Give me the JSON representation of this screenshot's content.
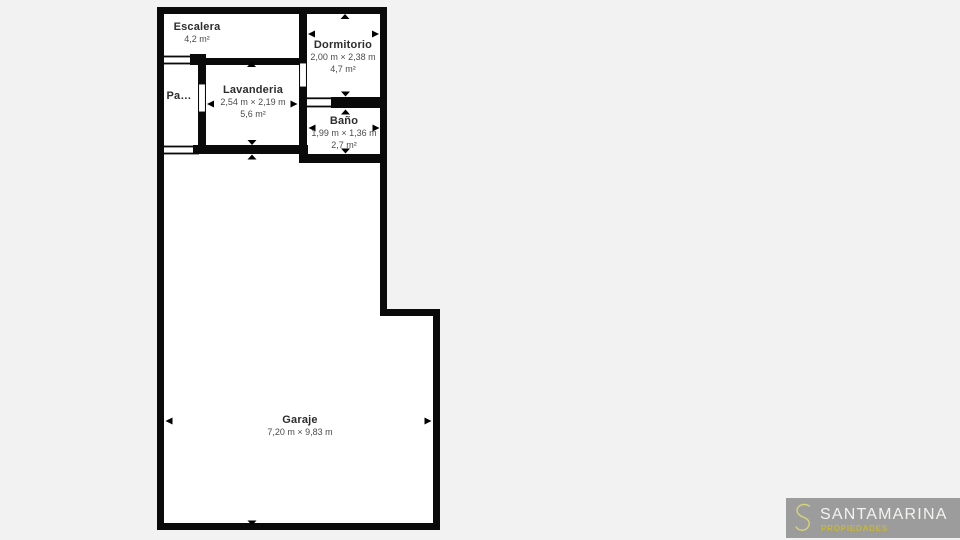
{
  "floor_plan": {
    "rooms": [
      {
        "id": "escalera",
        "name": "Escalera",
        "area": "4,2 m²"
      },
      {
        "id": "pasillo",
        "name": "Pa…"
      },
      {
        "id": "lavanderia",
        "name": "Lavanderia",
        "dimensions": "2,54 m × 2,19 m",
        "area": "5,6 m²"
      },
      {
        "id": "dormitorio",
        "name": "Dormitorio",
        "dimensions": "2,00 m × 2,38 m",
        "area": "4,7 m²"
      },
      {
        "id": "bano",
        "name": "Baño",
        "dimensions": "1,99 m × 1,36 m",
        "area": "2,7 m²"
      },
      {
        "id": "garaje",
        "name": "Garaje",
        "dimensions": "7,20 m × 9,83 m"
      }
    ]
  },
  "branding": {
    "monogram": "S",
    "name": "SANTAMARINA",
    "tagline": "PROPIEDADES"
  },
  "colors": {
    "page_background": "#f2f2f2",
    "wall": "#0a0a0a",
    "room_fill": "#ffffff",
    "room_name_text": "#2d2d2d",
    "room_dim_text": "#4b4b4b",
    "logo_background": "#9c9c9c",
    "logo_name_text": "#f3f3f1",
    "logo_tagline_text": "#c7b73b",
    "logo_monogram": "#d6d676"
  }
}
